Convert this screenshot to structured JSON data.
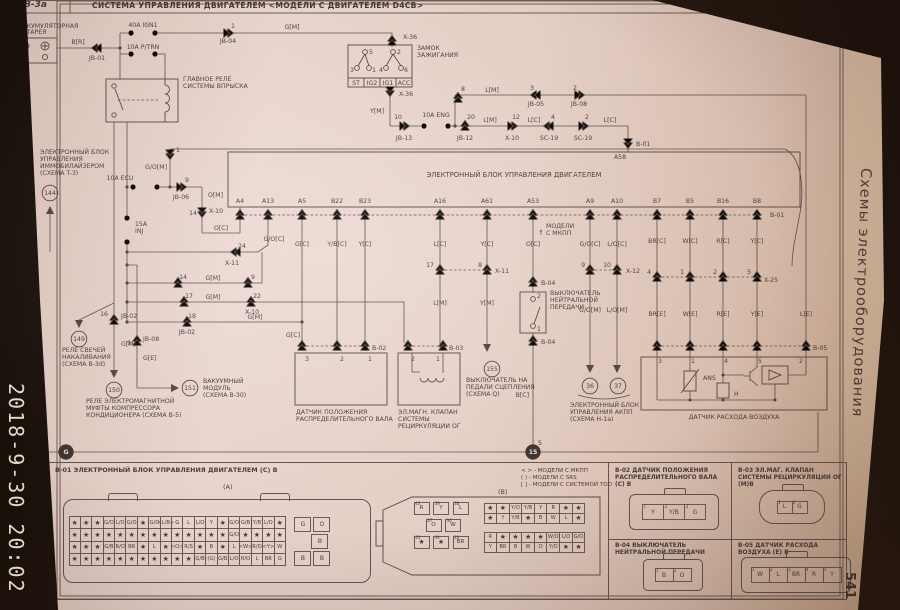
{
  "meta": {
    "timestamp": "2018-9-30 20:02",
    "page_number": "541",
    "sidebar_title": "Схемы электрооборудования"
  },
  "header": {
    "code": "B-3a",
    "title": "СИСТЕМА УПРАВЛЕНИЯ ДВИГАТЕЛЕМ <МОДЕЛИ С ДВИГАТЕЛЕМ D4CB>"
  },
  "schematic": {
    "labels": [
      {
        "t": "АККУМУЛЯТОРНАЯ",
        "x": 18,
        "y": 28,
        "a": "s"
      },
      {
        "t": "БАТАРЕЯ",
        "x": 18,
        "y": 34,
        "a": "s"
      },
      {
        "t": "40A IGN1",
        "x": 143,
        "y": 27
      },
      {
        "t": "10A P/TRN",
        "x": 143,
        "y": 49
      },
      {
        "t": "B[R]",
        "x": 78,
        "y": 44
      },
      {
        "t": "JB-01",
        "x": 97,
        "y": 60
      },
      {
        "t": "1",
        "x": 233,
        "y": 28
      },
      {
        "t": "JB-04",
        "x": 228,
        "y": 43
      },
      {
        "t": "G[M]",
        "x": 292,
        "y": 29
      },
      {
        "t": "ГЛАВНОЕ РЕЛЕ",
        "x": 183,
        "y": 81,
        "a": "s"
      },
      {
        "t": "СИСТЕМЫ ВПРЫСКА",
        "x": 183,
        "y": 88,
        "a": "s"
      },
      {
        "t": "X-36",
        "x": 403,
        "y": 39,
        "a": "s"
      },
      {
        "t": "ЗАМОК",
        "x": 417,
        "y": 50,
        "a": "s"
      },
      {
        "t": "ЗАЖИГАНИЯ",
        "x": 417,
        "y": 57,
        "a": "s"
      },
      {
        "t": "5",
        "x": 371,
        "y": 54
      },
      {
        "t": "2",
        "x": 399,
        "y": 54
      },
      {
        "t": "3",
        "x": 352,
        "y": 72
      },
      {
        "t": "1",
        "x": 374,
        "y": 72
      },
      {
        "t": "4",
        "x": 381,
        "y": 72
      },
      {
        "t": "6",
        "x": 406,
        "y": 72
      },
      {
        "t": "ST",
        "x": 356,
        "y": 85
      },
      {
        "t": "IG2",
        "x": 372,
        "y": 85
      },
      {
        "t": "IG1",
        "x": 388,
        "y": 85
      },
      {
        "t": "ACC",
        "x": 404,
        "y": 85
      },
      {
        "t": "X-36",
        "x": 399,
        "y": 96,
        "a": "s"
      },
      {
        "t": "Y[M]",
        "x": 384,
        "y": 113,
        "a": "e"
      },
      {
        "t": "10",
        "x": 398,
        "y": 119
      },
      {
        "t": "JB-13",
        "x": 404,
        "y": 140
      },
      {
        "t": "10A ENG",
        "x": 436,
        "y": 117
      },
      {
        "t": "20",
        "x": 471,
        "y": 119
      },
      {
        "t": "JB-12",
        "x": 465,
        "y": 140
      },
      {
        "t": "L[M]",
        "x": 490,
        "y": 122
      },
      {
        "t": "12",
        "x": 516,
        "y": 119
      },
      {
        "t": "X-10",
        "x": 512,
        "y": 140
      },
      {
        "t": "L[C]",
        "x": 534,
        "y": 122
      },
      {
        "t": "4",
        "x": 553,
        "y": 119
      },
      {
        "t": "SC-19",
        "x": 549,
        "y": 140
      },
      {
        "t": "2",
        "x": 587,
        "y": 119
      },
      {
        "t": "SC-19",
        "x": 583,
        "y": 140
      },
      {
        "t": "L[C]",
        "x": 610,
        "y": 122
      },
      {
        "t": "B-01",
        "x": 636,
        "y": 146,
        "a": "s"
      },
      {
        "t": "A58",
        "x": 620,
        "y": 159
      },
      {
        "t": "8",
        "x": 463,
        "y": 91
      },
      {
        "t": "L[M]",
        "x": 492,
        "y": 92
      },
      {
        "t": "3",
        "x": 532,
        "y": 90
      },
      {
        "t": "JB-05",
        "x": 536,
        "y": 106
      },
      {
        "t": "2",
        "x": 575,
        "y": 90
      },
      {
        "t": "JB-08",
        "x": 579,
        "y": 106
      },
      {
        "t": "ЭЛЕКТРОННЫЙ БЛОК",
        "x": 40,
        "y": 154,
        "a": "s"
      },
      {
        "t": "УПРАВЛЕНИЯ",
        "x": 40,
        "y": 161,
        "a": "s"
      },
      {
        "t": "ИММОБИЛАЙЗЕРОМ",
        "x": 40,
        "y": 168,
        "a": "s"
      },
      {
        "t": "(СХЕМА T-3)",
        "x": 40,
        "y": 175,
        "a": "s"
      },
      {
        "t": "144",
        "x": 50,
        "y": 193,
        "bg": "c"
      },
      {
        "t": "10A ECU",
        "x": 120,
        "y": 180
      },
      {
        "t": "G/O[M]",
        "x": 167,
        "y": 169,
        "a": "e"
      },
      {
        "t": "1",
        "x": 176,
        "y": 152,
        "a": "s"
      },
      {
        "t": "9",
        "x": 187,
        "y": 182
      },
      {
        "t": "JB-06",
        "x": 181,
        "y": 199
      },
      {
        "t": "O[M]",
        "x": 208,
        "y": 197,
        "a": "s"
      },
      {
        "t": "14",
        "x": 197,
        "y": 215,
        "a": "e"
      },
      {
        "t": "X-10",
        "x": 209,
        "y": 213,
        "a": "s"
      },
      {
        "t": "O[C]",
        "x": 221,
        "y": 230
      },
      {
        "t": "15A",
        "x": 135,
        "y": 226,
        "a": "s"
      },
      {
        "t": "INJ",
        "x": 135,
        "y": 233,
        "a": "s"
      },
      {
        "t": "24",
        "x": 242,
        "y": 248
      },
      {
        "t": "X-11",
        "x": 232,
        "y": 265
      },
      {
        "t": "14",
        "x": 183,
        "y": 279
      },
      {
        "t": "G[M]",
        "x": 213,
        "y": 280
      },
      {
        "t": "9",
        "x": 253,
        "y": 279
      },
      {
        "t": "17",
        "x": 189,
        "y": 298
      },
      {
        "t": "G[M]",
        "x": 213,
        "y": 299
      },
      {
        "t": "22",
        "x": 257,
        "y": 298
      },
      {
        "t": "X-10",
        "x": 252,
        "y": 314
      },
      {
        "t": "18",
        "x": 192,
        "y": 318
      },
      {
        "t": "JB-02",
        "x": 187,
        "y": 334
      },
      {
        "t": "G[M]",
        "x": 255,
        "y": 319
      },
      {
        "t": "16",
        "x": 108,
        "y": 316,
        "a": "e"
      },
      {
        "t": "JB-02",
        "x": 121,
        "y": 318,
        "a": "s"
      },
      {
        "t": "G[M]",
        "x": 121,
        "y": 346,
        "a": "s"
      },
      {
        "t": "149",
        "x": 79,
        "y": 339,
        "bg": "c"
      },
      {
        "t": "РЕЛЕ СВЕЧЕЙ",
        "x": 62,
        "y": 352,
        "a": "s"
      },
      {
        "t": "НАКАЛИВАНИЯ",
        "x": 62,
        "y": 359,
        "a": "s"
      },
      {
        "t": "(СХЕМА B-3d)",
        "x": 62,
        "y": 366,
        "a": "s"
      },
      {
        "t": "9",
        "x": 131,
        "y": 345,
        "a": "e"
      },
      {
        "t": "JB-08",
        "x": 143,
        "y": 341,
        "a": "s"
      },
      {
        "t": "G[E]",
        "x": 143,
        "y": 360,
        "a": "s"
      },
      {
        "t": "150",
        "x": 114,
        "y": 390,
        "bg": "c"
      },
      {
        "t": "РЕЛЕ ЭЛЕКТРОМАГНИТНОЙ",
        "x": 86,
        "y": 403,
        "a": "s"
      },
      {
        "t": "МУФТЫ КОМПРЕССОРА",
        "x": 86,
        "y": 410,
        "a": "s"
      },
      {
        "t": "КОНДИЦИОНЕРА (СХЕМА B-5)",
        "x": 86,
        "y": 417,
        "a": "s"
      },
      {
        "t": "151",
        "x": 190,
        "y": 388,
        "bg": "c"
      },
      {
        "t": "ВАКУУМНЫЙ",
        "x": 203,
        "y": 383,
        "a": "s"
      },
      {
        "t": "МОДУЛЬ",
        "x": 203,
        "y": 390,
        "a": "s"
      },
      {
        "t": "(СХЕМА B-30)",
        "x": 203,
        "y": 397,
        "a": "s"
      },
      {
        "t": "ЭЛЕКТРОННЫЙ БЛОК УПРАВЛЕНИЯ ДВИГАТЕЛЕМ",
        "x": 514,
        "y": 177,
        "fs": 6.8
      },
      {
        "t": "A4",
        "x": 240,
        "y": 203
      },
      {
        "t": "A13",
        "x": 268,
        "y": 203
      },
      {
        "t": "A5",
        "x": 302,
        "y": 203
      },
      {
        "t": "B22",
        "x": 337,
        "y": 203
      },
      {
        "t": "B23",
        "x": 365,
        "y": 203
      },
      {
        "t": "A16",
        "x": 440,
        "y": 203
      },
      {
        "t": "A61",
        "x": 487,
        "y": 203
      },
      {
        "t": "A53",
        "x": 533,
        "y": 203
      },
      {
        "t": "A9",
        "x": 590,
        "y": 203
      },
      {
        "t": "A10",
        "x": 617,
        "y": 203
      },
      {
        "t": "B7",
        "x": 657,
        "y": 203
      },
      {
        "t": "B5",
        "x": 690,
        "y": 203
      },
      {
        "t": "B16",
        "x": 723,
        "y": 203
      },
      {
        "t": "B8",
        "x": 757,
        "y": 203
      },
      {
        "t": "B-01",
        "x": 770,
        "y": 217,
        "a": "s"
      },
      {
        "t": "G/O[C]",
        "x": 274,
        "y": 241
      },
      {
        "t": "G[C]",
        "x": 302,
        "y": 246
      },
      {
        "t": "Y/B[C]",
        "x": 337,
        "y": 246
      },
      {
        "t": "Y[C]",
        "x": 365,
        "y": 246
      },
      {
        "t": "L[C]",
        "x": 440,
        "y": 246
      },
      {
        "t": "Y[C]",
        "x": 487,
        "y": 246
      },
      {
        "t": "O[C]",
        "x": 533,
        "y": 246
      },
      {
        "t": "G/O[C]",
        "x": 590,
        "y": 246
      },
      {
        "t": "L/O[C]",
        "x": 617,
        "y": 246
      },
      {
        "t": "BR[C]",
        "x": 657,
        "y": 243
      },
      {
        "t": "W[C]",
        "x": 690,
        "y": 243
      },
      {
        "t": "R[C]",
        "x": 723,
        "y": 243
      },
      {
        "t": "Y[C]",
        "x": 757,
        "y": 243
      },
      {
        "t": "↑",
        "x": 541,
        "y": 235,
        "fs": 7
      },
      {
        "t": "МОДЕЛИ",
        "x": 546,
        "y": 228,
        "a": "s"
      },
      {
        "t": "С МКПП",
        "x": 546,
        "y": 235,
        "a": "s"
      },
      {
        "t": "17",
        "x": 434,
        "y": 267,
        "a": "e"
      },
      {
        "t": "8",
        "x": 482,
        "y": 267,
        "a": "e"
      },
      {
        "t": "X-11",
        "x": 495,
        "y": 273,
        "a": "s"
      },
      {
        "t": "L[M]",
        "x": 440,
        "y": 305
      },
      {
        "t": "Y[M]",
        "x": 487,
        "y": 305
      },
      {
        "t": "9",
        "x": 585,
        "y": 267,
        "a": "e"
      },
      {
        "t": "10",
        "x": 611,
        "y": 267,
        "a": "e"
      },
      {
        "t": "X-12",
        "x": 626,
        "y": 273,
        "a": "s"
      },
      {
        "t": "G/O[M]",
        "x": 590,
        "y": 312
      },
      {
        "t": "L/O[M]",
        "x": 617,
        "y": 312
      },
      {
        "t": "4",
        "x": 651,
        "y": 274,
        "a": "e"
      },
      {
        "t": "1",
        "x": 684,
        "y": 274,
        "a": "e"
      },
      {
        "t": "2",
        "x": 717,
        "y": 274,
        "a": "e"
      },
      {
        "t": "5",
        "x": 751,
        "y": 274,
        "a": "e"
      },
      {
        "t": "X-25",
        "x": 764,
        "y": 282,
        "a": "s"
      },
      {
        "t": "BR[E]",
        "x": 657,
        "y": 316
      },
      {
        "t": "W[E]",
        "x": 690,
        "y": 316
      },
      {
        "t": "R[E]",
        "x": 723,
        "y": 316
      },
      {
        "t": "Y[E]",
        "x": 757,
        "y": 316
      },
      {
        "t": "L[E]",
        "x": 806,
        "y": 316
      },
      {
        "t": "B-05",
        "x": 813,
        "y": 350,
        "a": "s"
      },
      {
        "t": "3",
        "x": 660,
        "y": 363
      },
      {
        "t": "1",
        "x": 693,
        "y": 363
      },
      {
        "t": "4",
        "x": 726,
        "y": 363
      },
      {
        "t": "5",
        "x": 760,
        "y": 363
      },
      {
        "t": "2",
        "x": 801,
        "y": 363
      },
      {
        "t": "ANS",
        "x": 703,
        "y": 380,
        "a": "s"
      },
      {
        "t": "H",
        "x": 734,
        "y": 396,
        "a": "s"
      },
      {
        "t": "ДАТЧИК РАСХОДА ВОЗДУХА",
        "x": 734,
        "y": 419
      },
      {
        "t": "155",
        "x": 492,
        "y": 369,
        "bg": "c"
      },
      {
        "t": "ВЫКЛЮЧАТЕЛЬ НА",
        "x": 466,
        "y": 382,
        "a": "s"
      },
      {
        "t": "ПЕДАЛИ СЦЕПЛЕНИЯ",
        "x": 466,
        "y": 389,
        "a": "s"
      },
      {
        "t": "(СХЕМА Q)",
        "x": 466,
        "y": 396,
        "a": "s"
      },
      {
        "t": "B-04",
        "x": 541,
        "y": 285,
        "a": "s"
      },
      {
        "t": "2",
        "x": 537,
        "y": 298,
        "a": "s"
      },
      {
        "t": "ВЫКЛЮЧАТЕЛЬ",
        "x": 550,
        "y": 295,
        "a": "s"
      },
      {
        "t": "НЕЙТРАЛЬНОЙ",
        "x": 550,
        "y": 302,
        "a": "s"
      },
      {
        "t": "ПЕРЕДАЧИ",
        "x": 550,
        "y": 309,
        "a": "s"
      },
      {
        "t": "1",
        "x": 537,
        "y": 331,
        "a": "s"
      },
      {
        "t": "B-04",
        "x": 541,
        "y": 344,
        "a": "s"
      },
      {
        "t": "B[C]",
        "x": 529,
        "y": 397,
        "a": "e"
      },
      {
        "t": "5",
        "x": 538,
        "y": 445,
        "a": "s"
      },
      {
        "t": "15",
        "x": 533,
        "y": 452,
        "bg": "cf"
      },
      {
        "t": "36",
        "x": 590,
        "y": 386,
        "bg": "c"
      },
      {
        "t": "37",
        "x": 618,
        "y": 386,
        "bg": "c"
      },
      {
        "t": "ЭЛЕКТРОННЫЙ БЛОК",
        "x": 570,
        "y": 407,
        "a": "s"
      },
      {
        "t": "УПРАВЛЕНИЯ АКПП",
        "x": 570,
        "y": 414,
        "a": "s"
      },
      {
        "t": "(СХЕМА H-1a)",
        "x": 570,
        "y": 421,
        "a": "s"
      },
      {
        "t": "B-02",
        "x": 372,
        "y": 350,
        "a": "s"
      },
      {
        "t": "3",
        "x": 307,
        "y": 361
      },
      {
        "t": "2",
        "x": 342,
        "y": 361
      },
      {
        "t": "1",
        "x": 370,
        "y": 361
      },
      {
        "t": "ДАТЧИК ПОЛОЖЕНИЯ",
        "x": 296,
        "y": 414,
        "a": "s"
      },
      {
        "t": "РАСПРЕДЕЛИТЕЛЬНОГО ВАЛА",
        "x": 296,
        "y": 421,
        "a": "s"
      },
      {
        "t": "G[C]",
        "x": 300,
        "y": 337,
        "a": "e"
      },
      {
        "t": "B-03",
        "x": 449,
        "y": 350,
        "a": "s"
      },
      {
        "t": "2",
        "x": 413,
        "y": 361
      },
      {
        "t": "1",
        "x": 438,
        "y": 361
      },
      {
        "t": "ЭЛ.МАГН. КЛАПАН",
        "x": 398,
        "y": 414,
        "a": "s"
      },
      {
        "t": "СИСТЕМЫ",
        "x": 398,
        "y": 421,
        "a": "s"
      },
      {
        "t": "РЕЦИРКУЛЯЦИИ ОГ",
        "x": 398,
        "y": 428,
        "a": "s"
      },
      {
        "t": "G",
        "x": 66,
        "y": 452,
        "bg": "cf"
      }
    ]
  },
  "bottom_panel": {
    "b01": {
      "title": "B-01 ЭЛЕКТРОННЫЙ БЛОК УПРАВЛЕНИЯ ДВИГАТЕЛЕМ (С) В",
      "a_label": "(A)",
      "b_label": "(B)",
      "legend": [
        "< > - МОДЕЛИ С МКПП",
        "( ) - МОДЕЛИ С SRS",
        "[ ] - МОДЕЛИ С СИСТЕМОЙ TOD"
      ],
      "conn_a": {
        "rows": [
          [
            "★",
            "★",
            "★",
            "G/O",
            "L/O",
            "G/O",
            "★",
            "G/O",
            "<L/B>",
            "G",
            "L",
            "L/O",
            "Y",
            "★",
            "G/O",
            "G/B",
            "[Y/B]",
            "L/O",
            "★"
          ],
          [
            "★",
            "★",
            "★",
            "★",
            "★",
            "★",
            "★",
            "★",
            "★",
            "★",
            "★",
            "★",
            "★",
            "★",
            "G/O",
            "★",
            "★",
            "★",
            "★"
          ],
          [
            "★",
            "★",
            "★",
            "G/B",
            "R/O",
            "BR",
            "★",
            "L",
            "★",
            "<O>",
            "R/S",
            "★",
            "B",
            "★",
            "L",
            "<W>",
            "R/O",
            "<Y>",
            "W"
          ],
          [
            "★",
            "★",
            "★",
            "★",
            "★",
            "★",
            "★",
            "★",
            "★",
            "★",
            "★",
            "(G/B)",
            "(G)",
            "G/B",
            "L/O",
            "R/O",
            "L",
            "BR",
            "G"
          ]
        ],
        "side_top": [
          "G",
          "O"
        ],
        "side_mid": [
          "B"
        ],
        "side_bottom": [
          "B",
          "B"
        ]
      },
      "conn_b": {
        "left_rows": [
          [
            "R",
            "Y",
            "L"
          ],
          [
            "O",
            "W"
          ],
          [
            "★",
            "★",
            "BR"
          ]
        ],
        "left_pins": [
          [
            "40",
            "39",
            "38"
          ],
          [
            "37",
            "36"
          ],
          [
            "35",
            "34",
            "33"
          ]
        ],
        "grid_top": [
          [
            "★",
            "★",
            "Y/O",
            "Y/B",
            "Y",
            "R",
            "★",
            "★"
          ],
          [
            "★",
            "Y",
            "Y/B",
            "★",
            "B",
            "W",
            "L",
            "★"
          ]
        ],
        "grid_bottom": [
          [
            "R",
            "★",
            "★",
            "★",
            "★",
            "W/O",
            "L/O",
            "G/O"
          ],
          [
            "Y",
            "BR",
            "B",
            "W",
            "O",
            "Y/O",
            "★",
            "★"
          ]
        ]
      }
    },
    "b02": {
      "title": "B-02 ДАТЧИК ПОЛОЖЕНИЯ РАСПРЕДЕЛИТЕЛЬНОГО ВАЛА (С) В",
      "cells": [
        "Y",
        "Y/B",
        "G"
      ],
      "pins": [
        "1",
        "2",
        "3"
      ]
    },
    "b03": {
      "title": "B-03 ЭЛ.МАГ. КЛАПАН СИСТЕМЫ РЕЦИРКУЛЯЦИИ ОГ (М)В",
      "cells": [
        "L",
        "G"
      ],
      "pins": [
        "1",
        "2"
      ]
    },
    "b04": {
      "title": "B-04 ВЫКЛЮЧАТЕЛЬ НЕЙТРАЛЬНОЙ ПЕРЕДАЧИ",
      "cells": [
        "B",
        "O"
      ],
      "pins": [
        "1",
        "2"
      ]
    },
    "b05": {
      "title": "B-05 ДАТЧИК РАСХОДА ВОЗДУХА (E) В",
      "cells": [
        "W",
        "L",
        "BR",
        "R",
        "Y"
      ],
      "pins": [
        "1",
        "2",
        "3",
        "4",
        "5"
      ]
    }
  }
}
